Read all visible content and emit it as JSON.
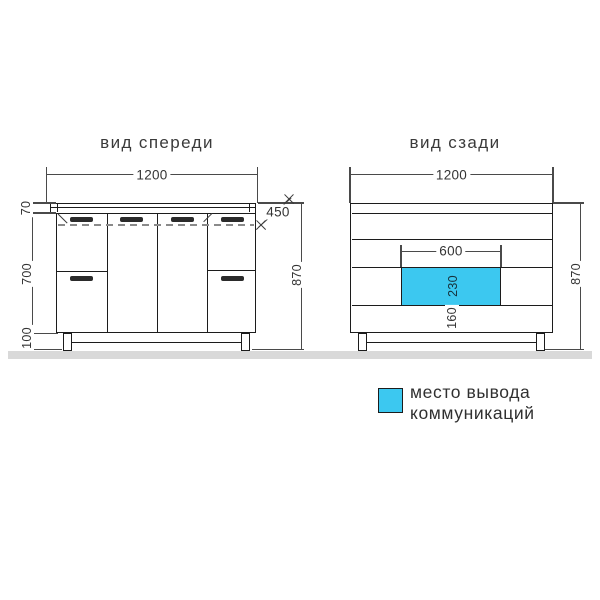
{
  "colors": {
    "cyan": "#3cc8f0",
    "line": "#1c1c1c",
    "text": "#343434",
    "floor": "#d9d9d9"
  },
  "front_view": {
    "title": "вид спереди",
    "dims": {
      "width": "1200",
      "countertop_height": "70",
      "body_height": "700",
      "legs_height": "100",
      "total_height": "870",
      "depth": "450"
    }
  },
  "back_view": {
    "title": "вид сзади",
    "dims": {
      "width": "1200",
      "cutout_width": "600",
      "cutout_height": "230",
      "bottom_offset": "160",
      "total_height": "870"
    }
  },
  "legend": {
    "line1": "место вывода",
    "line2": "коммуникаций"
  }
}
